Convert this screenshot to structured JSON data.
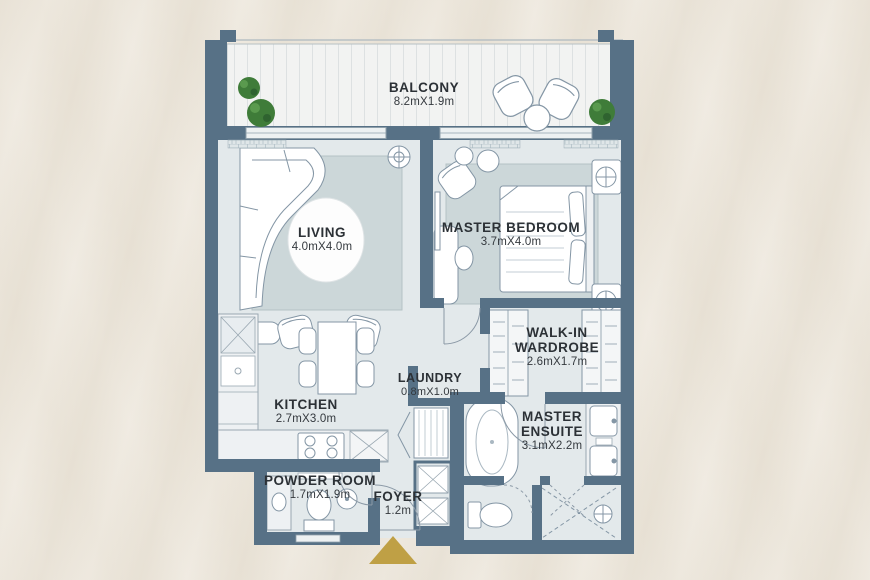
{
  "floorplan": {
    "rooms": [
      {
        "id": "balcony",
        "name": "BALCONY",
        "dims": "8.2mX1.9m"
      },
      {
        "id": "living",
        "name": "LIVING",
        "dims": "4.0mX4.0m"
      },
      {
        "id": "master-bedroom",
        "name": "MASTER BEDROOM",
        "dims": "3.7mX4.0m"
      },
      {
        "id": "walk-in-wardrobe",
        "name": "WALK-IN WARDROBE",
        "dims": "2.6mX1.7m"
      },
      {
        "id": "kitchen",
        "name": "KITCHEN",
        "dims": "2.7mX3.0m"
      },
      {
        "id": "laundry",
        "name": "LAUNDRY",
        "dims": "0.8mX1.0m"
      },
      {
        "id": "master-ensuite",
        "name": "MASTER ENSUITE",
        "dims": "3.1mX2.2m"
      },
      {
        "id": "powder-room",
        "name": "POWDER ROOM",
        "dims": "1.7mX1.9m"
      },
      {
        "id": "foyer",
        "name": "FOYER",
        "dims": "1.2m"
      }
    ],
    "entrance": {
      "marker": "entrance-arrow"
    },
    "colors": {
      "wall": "#577186",
      "floor": "#e3e9eb",
      "rug": "#ccd7d9",
      "balcony_floor": "#f2f3f2",
      "background": "#f0ebe2",
      "entrance_arrow": "#bfa045",
      "plant_green": "#3f7c39"
    }
  }
}
